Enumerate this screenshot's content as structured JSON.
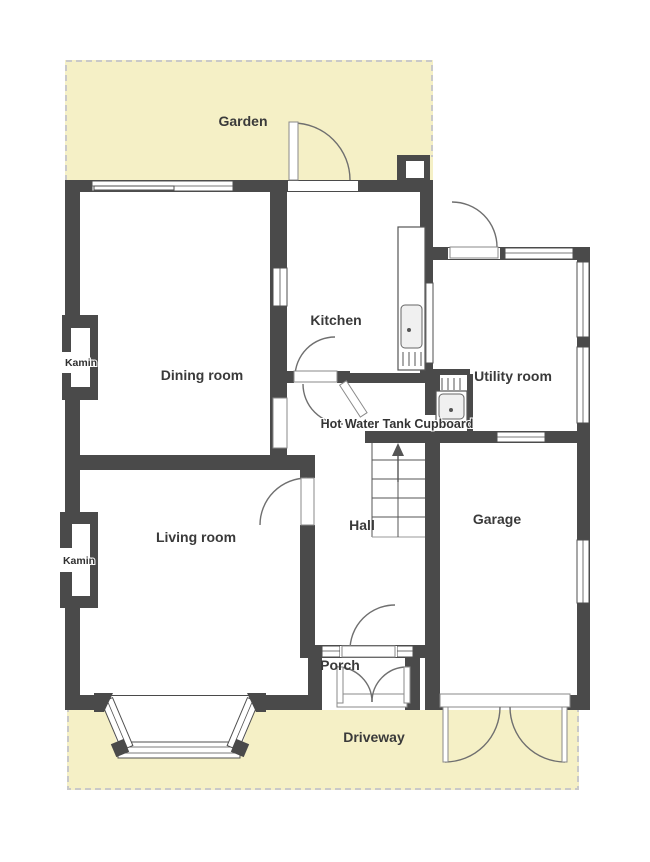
{
  "rooms": {
    "dining_room": {
      "label": "Dining room"
    },
    "kitchen": {
      "label": "Kitchen"
    },
    "utility_room": {
      "label": "Utility room"
    },
    "hall": {
      "label": "Hall"
    },
    "garage": {
      "label": "Garage"
    },
    "living_room": {
      "label": "Living room"
    },
    "porch": {
      "label": "Porch"
    }
  },
  "outdoor": {
    "garden": {
      "label": "Garden"
    },
    "driveway": {
      "label": "Driveway"
    }
  },
  "annotations": {
    "kamin_dining": {
      "label": "Kamin"
    },
    "kamin_living": {
      "label": "Kamin"
    },
    "hot_water_tank_cupboard": {
      "label": "Hot Water Tank Cupboard"
    }
  },
  "features": {
    "stairs_arrow": "up-arrow-icon",
    "kitchen_sink": "sink-icon",
    "hot_water_tank": "tank-icon",
    "fireplaces": "fireplace-icon",
    "door_swings": "door-arc-icon",
    "bay_window": "bay-window-icon"
  },
  "colors": {
    "wall": "#4a4a4a",
    "outdoor": "#f5f0c6",
    "text": "#3a3a3a",
    "line": "#4f4f4f",
    "arc": "#6f6f6f"
  }
}
